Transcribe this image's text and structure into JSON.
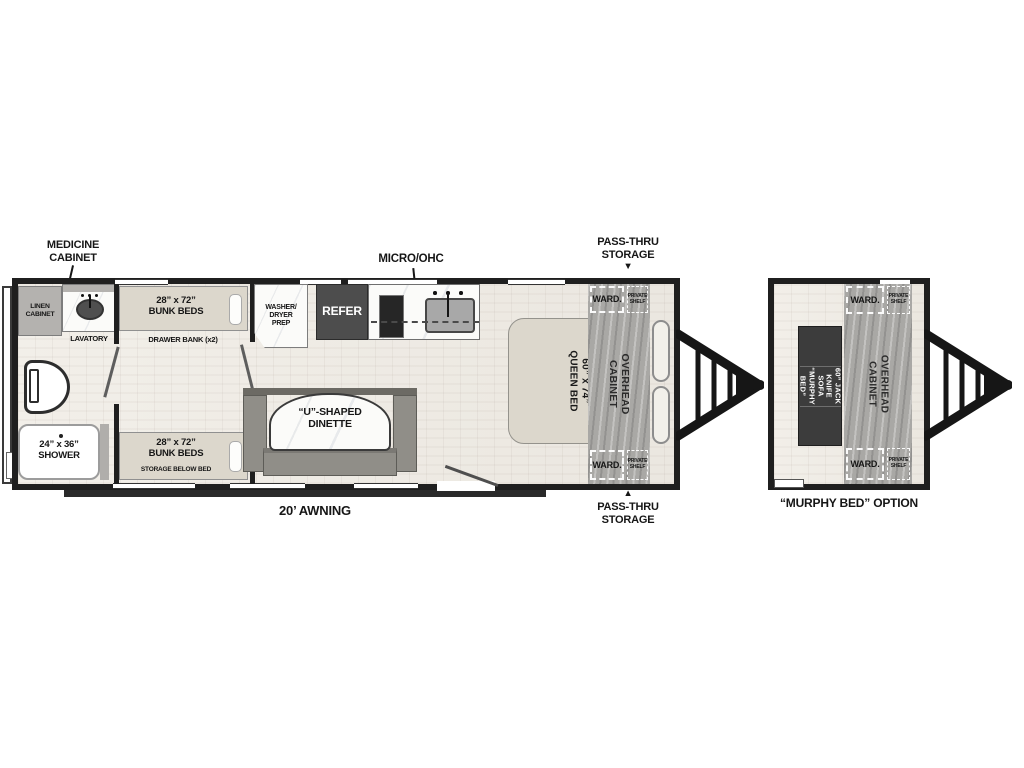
{
  "plan": {
    "callouts": {
      "medicine": "MEDICINE\nCABINET",
      "micro": "MICRO/OHC",
      "pass_thru": "PASS-THRU\nSTORAGE",
      "awning": "20’ AWNING",
      "arrow_down": "▼",
      "arrow_up": "▲"
    },
    "bath": {
      "linen": "LINEN\nCABINET",
      "lavatory": "LAVATORY",
      "shower": "24” x 36”\nSHOWER"
    },
    "bunkroom": {
      "bunk": "28” x 72”\nBUNK BEDS",
      "drawer_bank": "DRAWER BANK (x2)",
      "storage_below": "STORAGE BELOW BED"
    },
    "kitchen": {
      "washer_dryer": "WASHER/\nDRYER\nPREP",
      "refer": "REFER"
    },
    "dinette": {
      "label": "“U”-SHAPED\nDINETTE"
    },
    "bedroom": {
      "queen": "60” x 74”\nQUEEN BED",
      "ward": "WARD.",
      "private_shelf": "PRIVATE\nSHELF",
      "overhead": "OVERHEAD\nCABINET"
    }
  },
  "murphy": {
    "sofa": "60” JACK KNIFE SOFA\n“MURPHY BED”",
    "caption": "“MURPHY BED” OPTION"
  },
  "colors": {
    "wall": "#1f1f1f",
    "floor": "#efece6",
    "cabinet_gray": "#b4b2af",
    "wood_cabinet": "#a9a8a5",
    "bed_beige": "#dcd7cc",
    "refer_dark": "#4d4d4d",
    "sofa_dark": "#3c3c3c",
    "bench_gray": "#908e88",
    "counter_white": "#fbfbf9"
  }
}
